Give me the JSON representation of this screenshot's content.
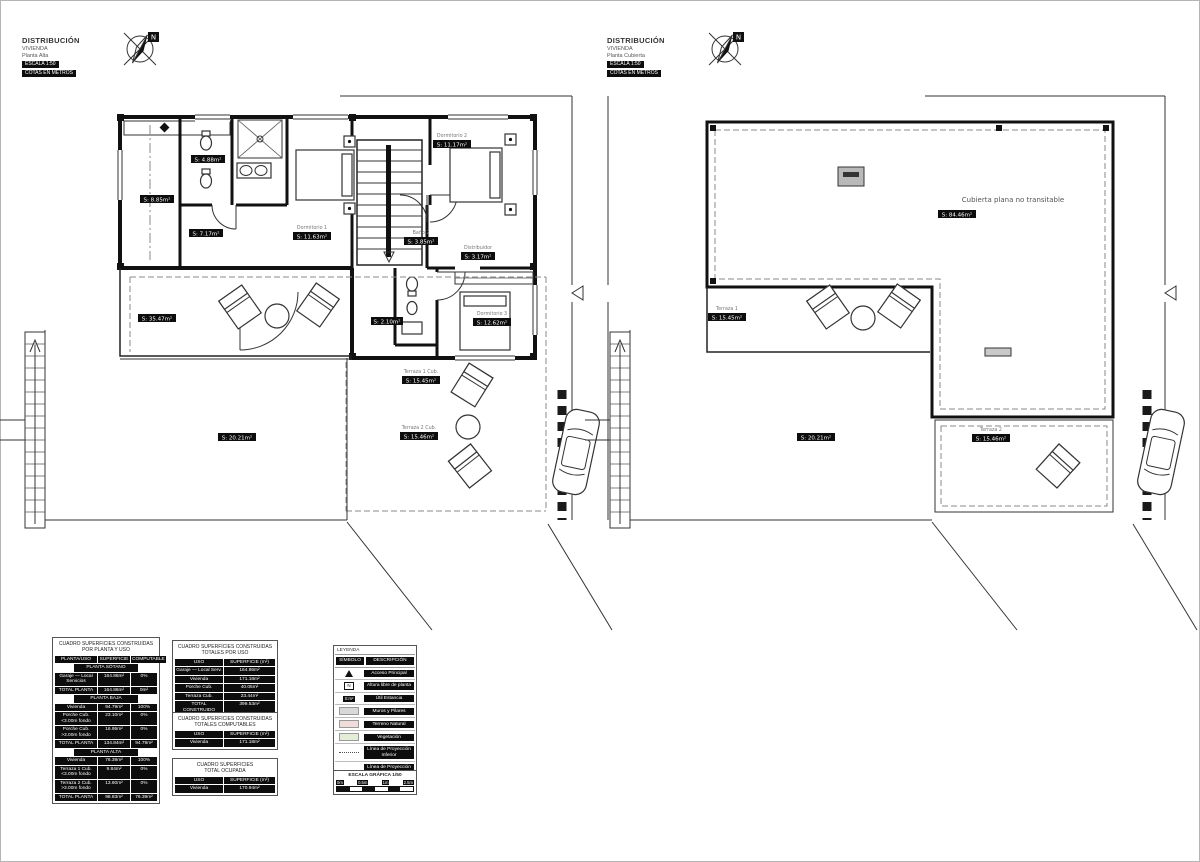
{
  "colors": {
    "wall": "#111111",
    "projection_line": "#8a8a8a",
    "chip_bg": "#0d0d0d",
    "chip_text": "#ffffff",
    "legend_gray": "#d9d9d9",
    "legend_pink": "#f0dcdb",
    "legend_green": "#e4edd8"
  },
  "titleblocks": {
    "left": {
      "l1": "DISTRIBUCIÓN",
      "l2": "VIVIENDA",
      "l3": "Planta Alta",
      "b1": "ESCALA 1:50",
      "b2": "COTAS EN METROS"
    },
    "right": {
      "l1": "DISTRIBUCIÓN",
      "l2": "VIVIENDA",
      "l3": "Planta Cubierta",
      "b1": "ESCALA 1:50",
      "b2": "COTAS EN METROS"
    }
  },
  "compass": {
    "letter": "N"
  },
  "plan_left": {
    "name": "Planta Alta",
    "labels": {
      "bath1": "S: 4.88m²",
      "lavadero": "S: 8.85m²",
      "vestidor": "S: 7.17m²",
      "dorm1_name": "Dormitorio 1",
      "dorm1": "S: 11.63m²",
      "dorm2_name": "Dormitorio 2",
      "dorm2": "S: 11.17m²",
      "bath2_name": "Baño 2",
      "bath2": "S: 3.85m²",
      "distribuidor_name": "Distribuidor",
      "distribuidor": "S: 3.17m²",
      "paso": "S: 2.10m²",
      "dorm3_name": "Dormitorio 3",
      "dorm3": "S: 12.62m²",
      "terraza_cubierta": "S: 35.47m²",
      "terraza1_name": "Terraza 1 Cub.",
      "terraza1": "S: 15.45m²",
      "terraza2_name": "Terraza 2 Cub.",
      "terraza2": "S: 15.46m²",
      "parcela": "S: 20.21m²"
    }
  },
  "plan_right": {
    "name": "Planta Cubierta",
    "labels": {
      "roof_note": "Cubierta plana no transitable",
      "roof_area": "S: 84.46m²",
      "terraza1_name": "Terraza 1",
      "terraza1": "S: 15.45m²",
      "terraza2_name": "Terraza 2",
      "terraza2": "S: 15.46m²",
      "parcela": "S: 20.21m²"
    }
  },
  "tables": {
    "por_planta": {
      "title1": "CUADRO SUPERFICIES CONSTRUIDAS",
      "title2": "POR PLANTA Y USO",
      "h": [
        "PLANTA/USO",
        "SUPERFICIE",
        "COMPUTABLE"
      ],
      "sections": [
        {
          "name": "PLANTA SÓTANO",
          "rows": [
            [
              "Garaje — Local Servicios",
              "164.86m²",
              "0%"
            ],
            [
              "TOTAL PLANTA",
              "164.86m²",
              "0m²"
            ]
          ]
        },
        {
          "name": "PLANTA BAJA",
          "rows": [
            [
              "Vivienda",
              "94.79m²",
              "100%"
            ],
            [
              "Porche Cub. <3.00m fondo",
              "23.10m²",
              "0%"
            ],
            [
              "Porche Cub. >3.00m fondo",
              "16.95m²",
              "0%"
            ],
            [
              "TOTAL PLANTA",
              "134.84m²",
              "94.79m²"
            ]
          ]
        },
        {
          "name": "PLANTA ALTA",
          "rows": [
            [
              "Vivienda",
              "76.39m²",
              "100%"
            ],
            [
              "Terraza 1 Cub. <3.00m fondo",
              "9.84m²",
              "0%"
            ],
            [
              "Terraza 2 Cub. >3.00m fondo",
              "13.60m²",
              "0%"
            ],
            [
              "TOTAL PLANTA",
              "98.83m²",
              "76.39m²"
            ]
          ]
        }
      ]
    },
    "totales_por_uso": {
      "title1": "CUADRO SUPERFICIES CONSTRUIDAS",
      "title2": "TOTALES POR USO",
      "h": [
        "USO",
        "SUPERFICIE (m²)"
      ],
      "rows": [
        [
          "Garaje — Local Serv.",
          "164.86m²"
        ],
        [
          "Vivienda",
          "171.18m²"
        ],
        [
          "Porche Cub.",
          "40.05m²"
        ],
        [
          "Terraza Cub.",
          "23.44m²"
        ],
        [
          "TOTAL CONSTRUIDO",
          "399.53m²"
        ]
      ]
    },
    "computables": {
      "title1": "CUADRO SUPERFICIES CONSTRUIDAS",
      "title2": "TOTALES COMPUTABLES",
      "h": [
        "USO",
        "SUPERFICIE (m²)"
      ],
      "rows": [
        [
          "Vivienda",
          "171.18m²"
        ]
      ]
    },
    "ocupada": {
      "title1": "CUADRO SUPERFICIES",
      "title2": "TOTAL OCUPADA",
      "h": [
        "USO",
        "SUPERFICIE (m²)"
      ],
      "rows": [
        [
          "Vivienda",
          "170.94m²"
        ]
      ]
    }
  },
  "legend": {
    "title": "LEYENDA",
    "h": [
      "SÍMBOLO",
      "DESCRIPCIÓN"
    ],
    "rows": [
      {
        "sym": "triangle",
        "desc": "Acceso Principal"
      },
      {
        "sym": "n-box",
        "sym_text": "N",
        "desc": "Altura libre de planta"
      },
      {
        "sym": "chip",
        "sym_text": "S:m²",
        "desc": "Útil Estancia"
      },
      {
        "sym": "swatch-gray",
        "desc": "Muros y Pilares"
      },
      {
        "sym": "swatch-pink",
        "desc": "Terreno Natural"
      },
      {
        "sym": "swatch-green",
        "desc": "Vegetación"
      },
      {
        "sym": "dashdot",
        "desc": "Línea de Proyección Inferior"
      },
      {
        "sym": "dashed",
        "desc": "Línea de Proyección Superior"
      }
    ],
    "scale": {
      "title": "ESCALA GRÁFICA 1/50",
      "ticks": [
        "0m",
        "0.5m",
        "1m",
        "2.5m"
      ]
    }
  }
}
